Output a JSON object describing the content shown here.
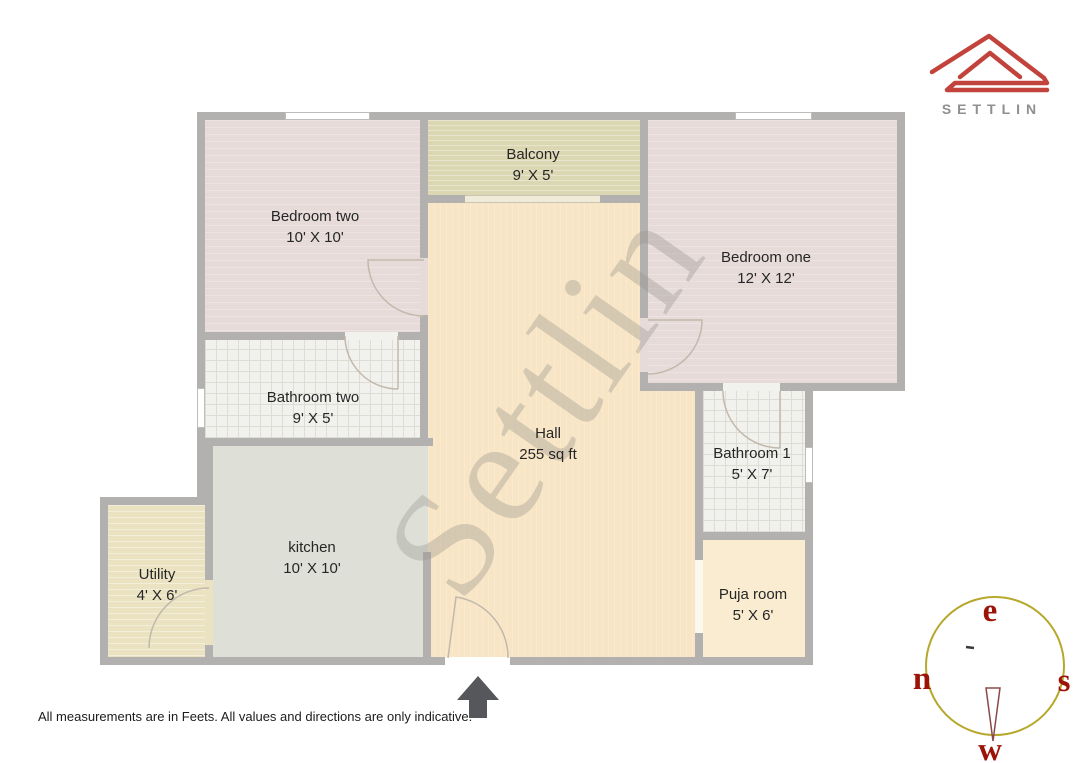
{
  "brand": {
    "name": "SETTLIN"
  },
  "watermark": {
    "text": "Settlin"
  },
  "rooms": [
    {
      "name": "Bedroom two",
      "dims": "10' X 10'"
    },
    {
      "name": "Balcony",
      "dims": "9' X 5'"
    },
    {
      "name": "Bedroom one",
      "dims": "12' X 12'"
    },
    {
      "name": "Bathroom two",
      "dims": "9' X 5'"
    },
    {
      "name": "Hall",
      "dims": "255 sq ft"
    },
    {
      "name": "Bathroom 1",
      "dims": "5' X 7'"
    },
    {
      "name": "kitchen",
      "dims": "10' X 10'"
    },
    {
      "name": "Utility",
      "dims": "4' X 6'"
    },
    {
      "name": "Puja room",
      "dims": "5' X 6'"
    }
  ],
  "compass": {
    "top": "e",
    "left": "n",
    "right": "s",
    "bottom": "w"
  },
  "footnote": "All measurements are in Feets. All values and directions are only indicative.",
  "colors": {
    "brand_red": "#c2423c",
    "brand_text": "#8f8f8f",
    "wall": "#b3b0b0",
    "compass_ring": "#b5a82b",
    "compass_letters": "#9c1408",
    "entrance_arrow": "#56575a"
  }
}
